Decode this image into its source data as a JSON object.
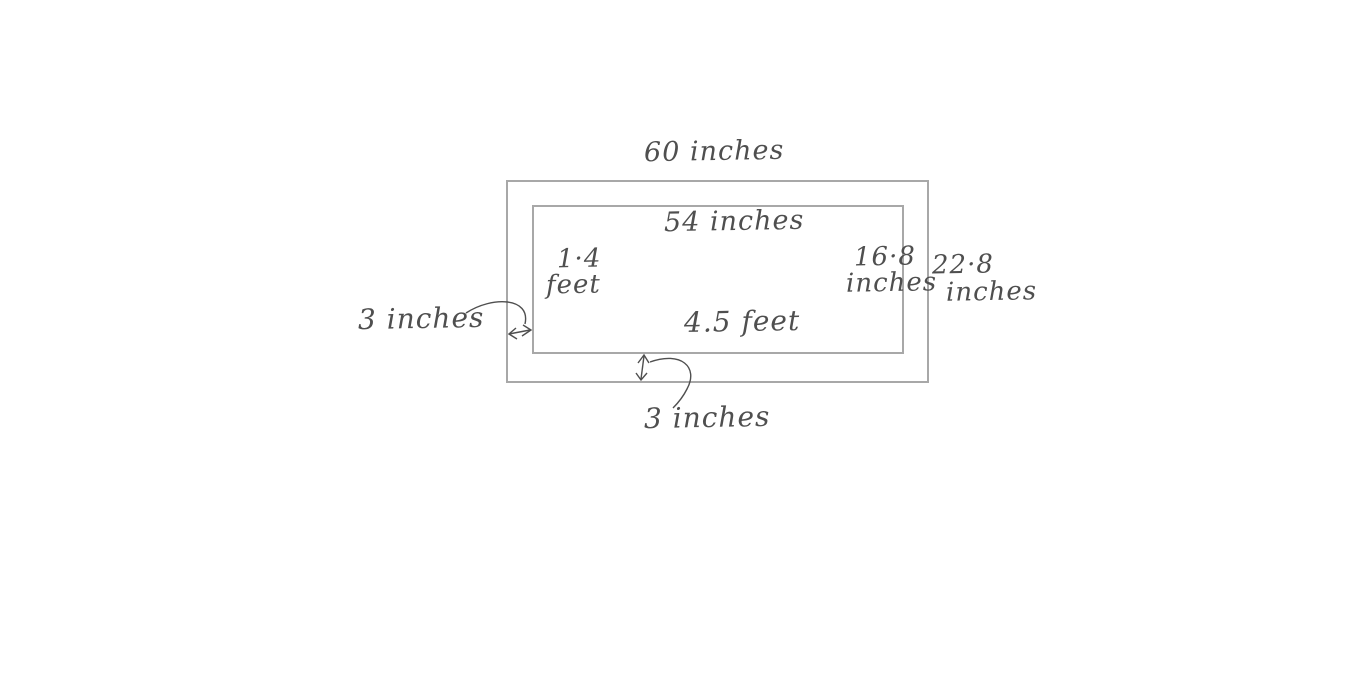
{
  "diagram": {
    "title_hint": "hand-drawn nested rectangles with picture frame measurements",
    "labels": {
      "outer_width_top": "60 inches",
      "inner_width_top": "54 inches",
      "inner_height_left_line1": "1·4",
      "inner_height_left_line2": "feet",
      "inner_height_right_line1": "16·8",
      "inner_height_right_line2": "inches",
      "outer_height_right_line1": "22·8",
      "outer_height_right_line2": "inches",
      "left_margin": "3 inches",
      "inner_width_bottom": "4.5 feet",
      "bottom_margin": "3 inches"
    },
    "colors": {
      "background": "#ffffff",
      "rect_stroke": "#a8a8a8",
      "ink": "#4f4f4f"
    }
  }
}
